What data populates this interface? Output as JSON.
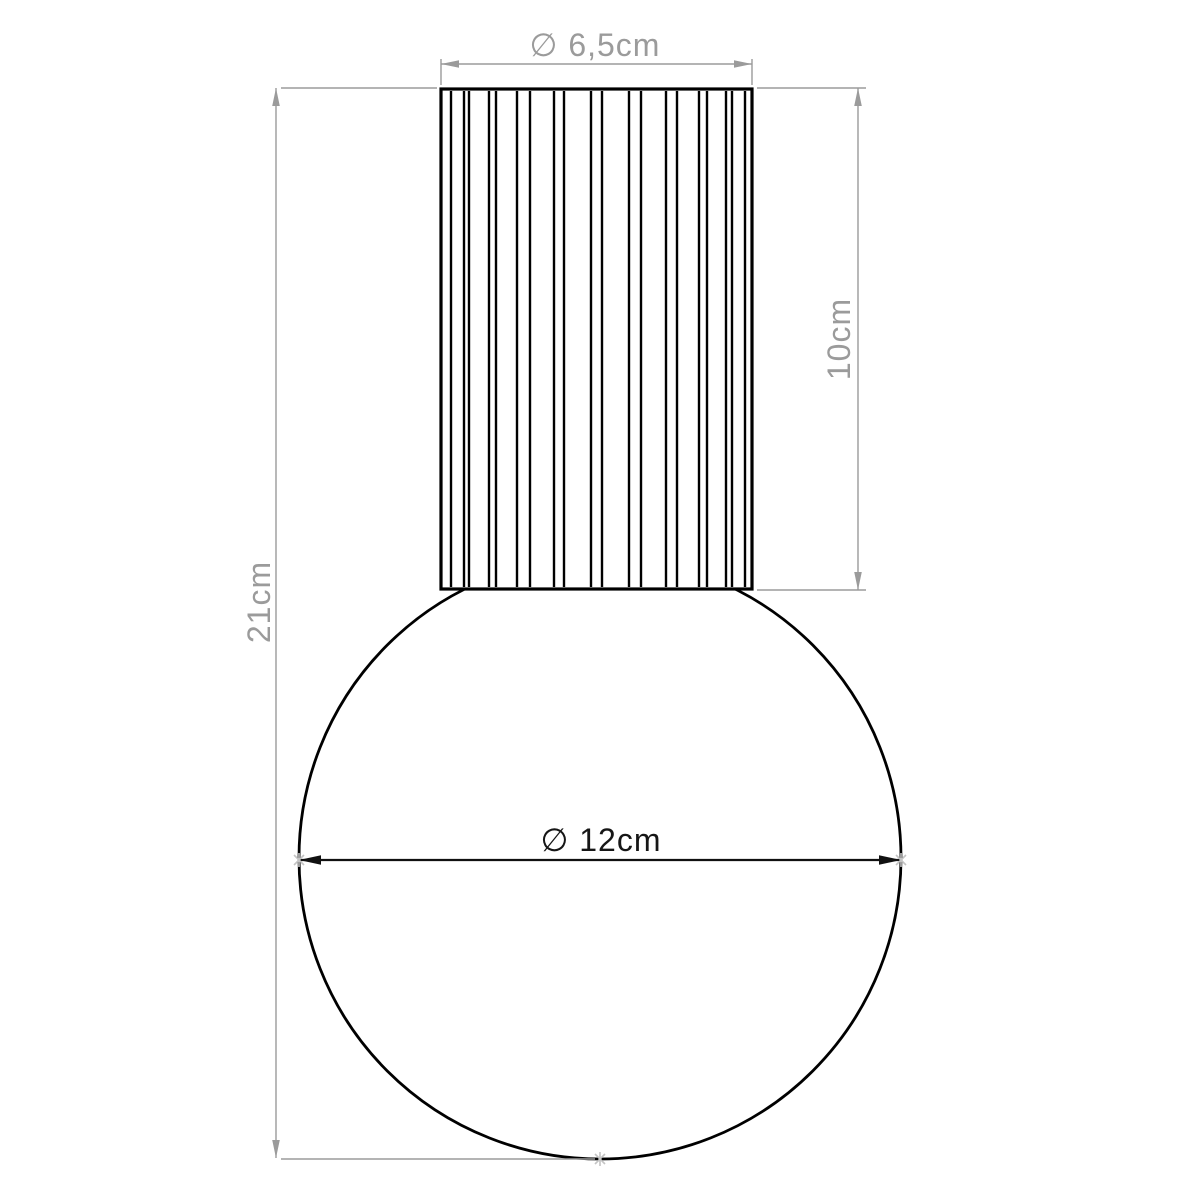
{
  "drawing": {
    "kind": "product-dimension-diagram",
    "background_color": "#ffffff",
    "outline_color": "#000000",
    "dim_line_color": "#9b9b9b",
    "dim_text_color": "#9b9b9b",
    "dark_dim_text_color": "#161616",
    "endpoint_mark_color": "#c4c4c4",
    "dimensions": [
      {
        "id": "shade-diameter",
        "label": "∅ 6,5cm",
        "value": 6.5,
        "unit": "cm",
        "kind": "diameter",
        "orientation": "horizontal",
        "measures": "top cylinder width"
      },
      {
        "id": "shade-height",
        "label": "10cm",
        "value": 10,
        "unit": "cm",
        "kind": "linear",
        "orientation": "vertical",
        "measures": "top cylinder height"
      },
      {
        "id": "total-height",
        "label": "21cm",
        "value": 21,
        "unit": "cm",
        "kind": "linear",
        "orientation": "vertical",
        "measures": "overall height"
      },
      {
        "id": "globe-diameter",
        "label": "∅ 12cm",
        "value": 12,
        "unit": "cm",
        "kind": "diameter",
        "orientation": "horizontal",
        "measures": "sphere diameter"
      }
    ]
  }
}
